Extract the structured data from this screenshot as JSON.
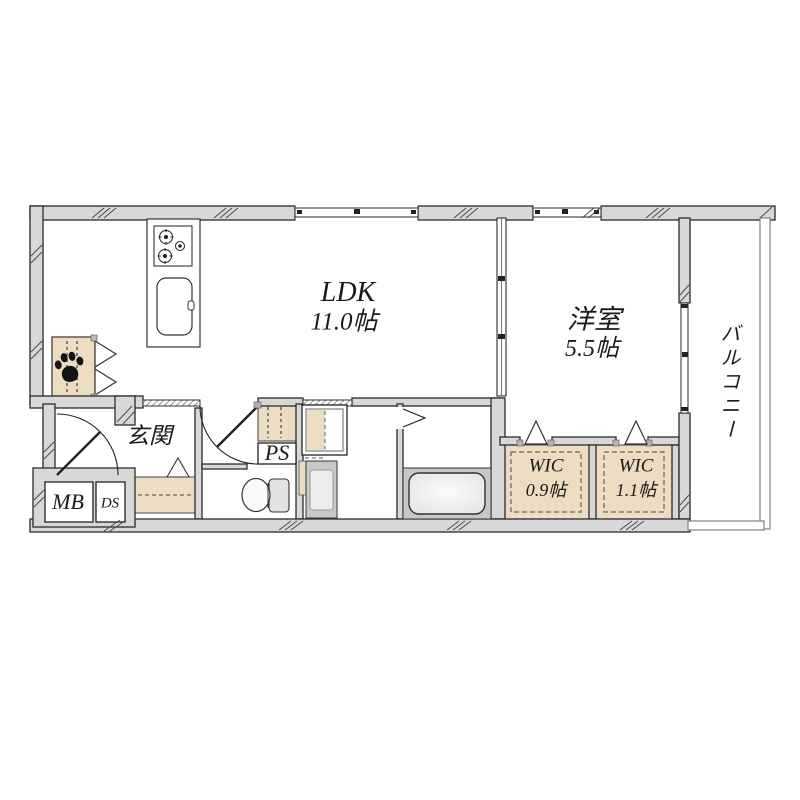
{
  "colors": {
    "wall_fill": "#d8d8d8",
    "outline": "#2b2b2b",
    "storage_beige": "#ebdcc2",
    "bath_gray": "#c7c7c7",
    "appliance_gray": "#cccccc",
    "text": "#1a1a1a"
  },
  "floor_plan": {
    "rooms": {
      "ldk": {
        "label": "LDK",
        "area": "11.0帖"
      },
      "bedroom": {
        "label": "洋室",
        "area": "5.5帖"
      },
      "balcony": {
        "label": "バルコニー"
      },
      "wic_left": {
        "label": "WIC",
        "area": "0.9帖"
      },
      "wic_right": {
        "label": "WIC",
        "area": "1.1帖"
      },
      "entrance": {
        "label": "玄関"
      },
      "pipe_space": {
        "label": "PS"
      },
      "meter_box": {
        "label": "MB"
      },
      "duct_space": {
        "label": "DS"
      }
    },
    "fixtures": [
      "kitchen-stove",
      "kitchen-sink",
      "bathtub",
      "toilet",
      "washbasin",
      "washing-machine",
      "shoe-cabinet",
      "pet-closet",
      "paw-icon",
      "entrance-door",
      "balcony-window",
      "sliding-partition"
    ]
  }
}
